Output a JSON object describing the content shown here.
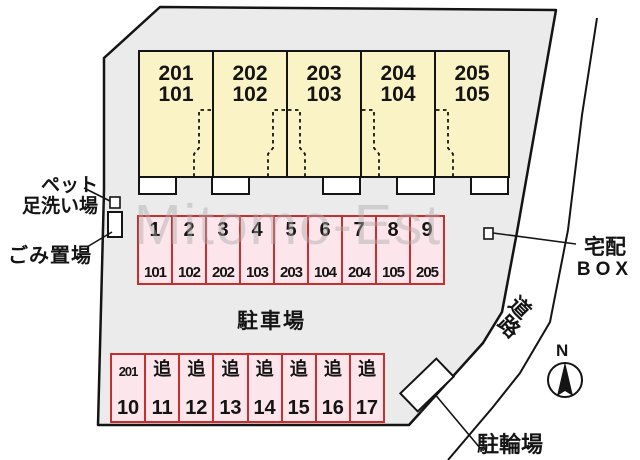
{
  "diagram": {
    "watermark": "Mitomo-Est",
    "building": {
      "units": [
        {
          "upper": "201",
          "lower": "101"
        },
        {
          "upper": "202",
          "lower": "102"
        },
        {
          "upper": "203",
          "lower": "103"
        },
        {
          "upper": "204",
          "lower": "104"
        },
        {
          "upper": "205",
          "lower": "105"
        }
      ]
    },
    "parking_row1": {
      "spaces": [
        {
          "no": "1",
          "unit": "101"
        },
        {
          "no": "2",
          "unit": "102"
        },
        {
          "no": "3",
          "unit": "202"
        },
        {
          "no": "4",
          "unit": "103"
        },
        {
          "no": "5",
          "unit": "203"
        },
        {
          "no": "6",
          "unit": "104"
        },
        {
          "no": "7",
          "unit": "204"
        },
        {
          "no": "8",
          "unit": "105"
        },
        {
          "no": "9",
          "unit": "205"
        }
      ]
    },
    "parking_row2": {
      "spaces": [
        {
          "top": "201",
          "bottom": "10"
        },
        {
          "top": "追",
          "bottom": "11"
        },
        {
          "top": "追",
          "bottom": "12"
        },
        {
          "top": "追",
          "bottom": "13"
        },
        {
          "top": "追",
          "bottom": "14"
        },
        {
          "top": "追",
          "bottom": "15"
        },
        {
          "top": "追",
          "bottom": "16"
        },
        {
          "top": "追",
          "bottom": "17"
        }
      ]
    },
    "labels": {
      "pet_wash_line1": "ペット",
      "pet_wash_line2": "足洗い場",
      "garbage": "ごみ置場",
      "parking_lot": "駐車場",
      "delivery_line1": "宅配",
      "delivery_line2": "BOX",
      "road_char1": "道",
      "road_char2": "路",
      "bike_parking": "駐輪場",
      "north": "N"
    },
    "colors": {
      "ground": "#ebebeb",
      "unit_fill": "#faf3c5",
      "parking_fill": "#fce6ec",
      "parking_border": "#c62f2f",
      "line": "#141414"
    }
  }
}
